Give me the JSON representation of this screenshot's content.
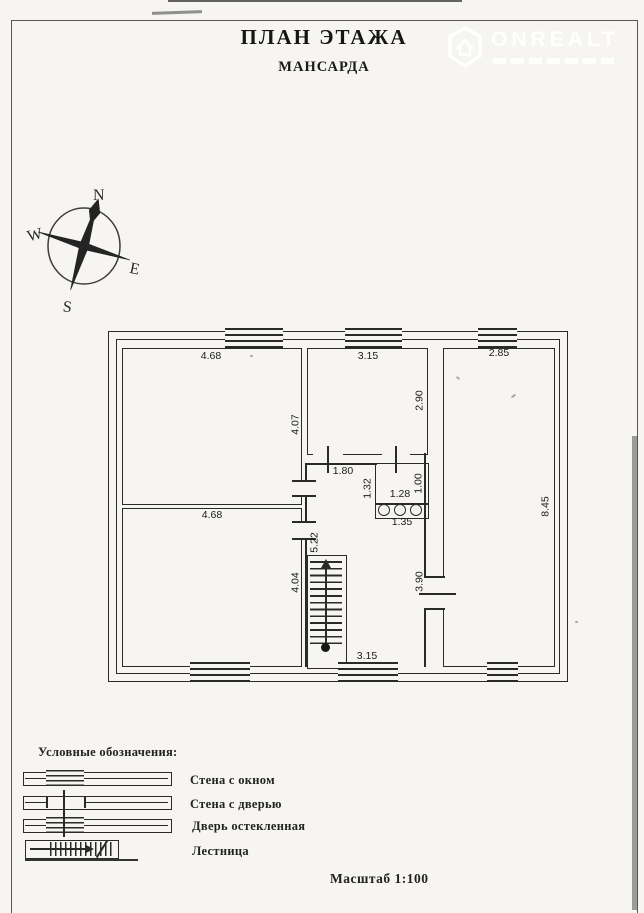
{
  "page": {
    "title": "ПЛАН ЭТАЖА",
    "subtitle": "МАНСАРДА",
    "scale_label": "Масштаб 1:100"
  },
  "watermark": {
    "brand": "ONREALT"
  },
  "compass": {
    "north": "N",
    "west": "W",
    "east": "E",
    "south": "S"
  },
  "plan": {
    "dims": {
      "room1_width": "4.68",
      "room1_height": "4.07",
      "room2_width": "4.68",
      "room2_height": "4.04",
      "room3_width": "3.15",
      "room3_height": "2.90",
      "room4_width": "2.85",
      "room4_height": "8.45",
      "hall_width": "1.80",
      "hall_height": "5.22",
      "hall_bottom_width": "3.15",
      "bath_width": "1.28",
      "bath_height": "1.00",
      "bath_left": "1.32",
      "bath_niche": "1.35",
      "right_wall": "3.90"
    }
  },
  "legend": {
    "heading": "Условные обозначения:",
    "items": [
      {
        "label": "Стена с окном"
      },
      {
        "label": "Стена с дверью"
      },
      {
        "label": "Дверь остекленная"
      },
      {
        "label": "Лестница"
      }
    ]
  },
  "colors": {
    "line": "#2a2a2a",
    "paper": "#f6f5f2"
  }
}
